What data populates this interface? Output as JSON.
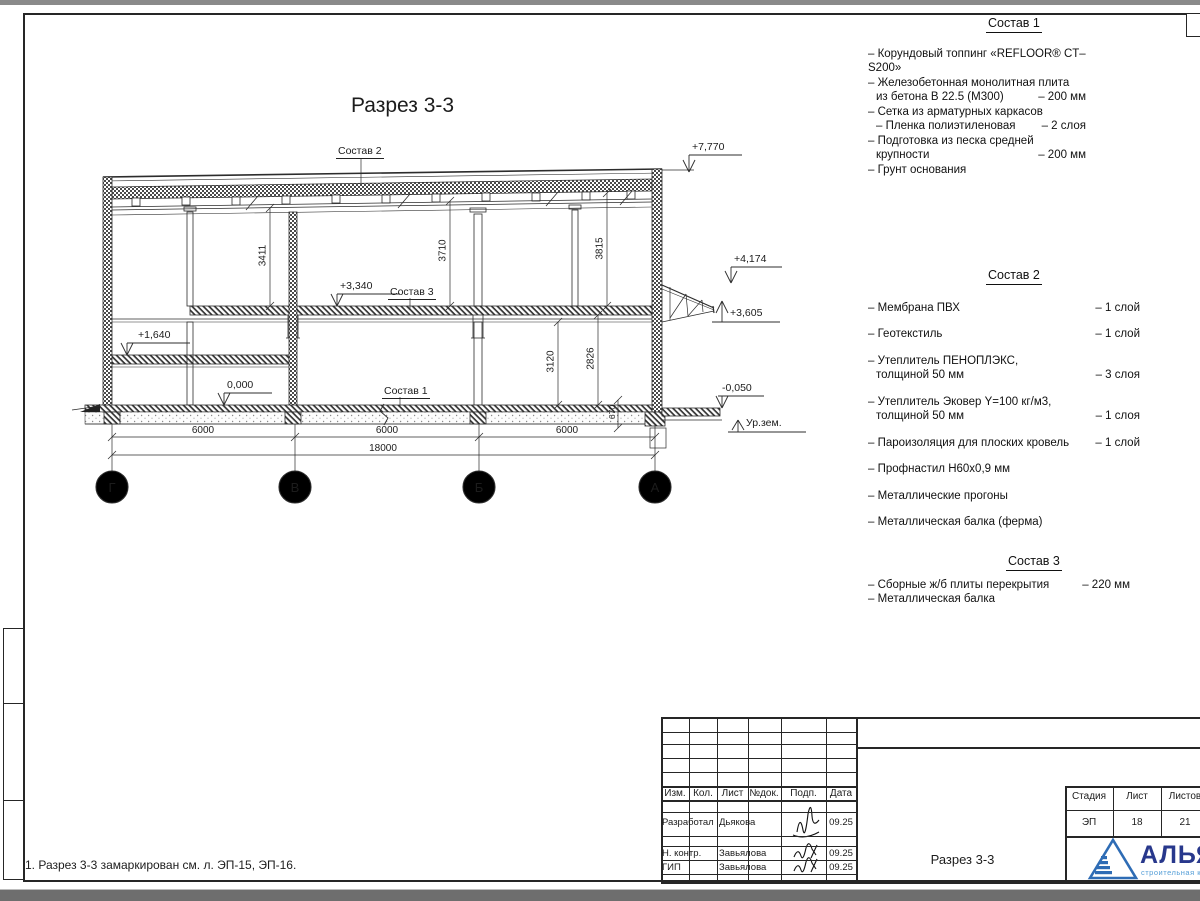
{
  "chrome": {
    "top_band": "#8a8a8a",
    "bottom_band": "#6e6e6e"
  },
  "drawing": {
    "title": "Разрез 3-3",
    "callouts": {
      "sostav1": "Состав 1",
      "sostav2": "Состав 2",
      "sostav3": "Состав 3"
    },
    "elevations": {
      "roof": "+7,770",
      "canopy_top": "+4,174",
      "canopy_bot": "+3,605",
      "slab": "+3,340",
      "mezz": "+1,640",
      "zero": "0,000",
      "outside": "-0,050",
      "ground": "Ур.зем."
    },
    "vdims": {
      "d1": "3411",
      "d2": "3710",
      "d3": "3815",
      "d4": "3120",
      "d5": "2826",
      "d6": "670"
    },
    "hdims": {
      "s1": "6000",
      "s2": "6000",
      "s3": "6000",
      "total": "18000"
    },
    "axes": {
      "a1": "Г",
      "a2": "В",
      "a3": "Б",
      "a4": "А"
    }
  },
  "specs": {
    "s1": {
      "title": "Состав 1",
      "items": [
        {
          "t": "– Корундовый топпинг «REFLOOR® CT–S200»",
          "v": ""
        },
        {
          "t": "– Железобетонная  монолитная плита",
          "v": ""
        },
        {
          "t": "из бетона В 22.5 (М300)",
          "v": "– 200 мм"
        },
        {
          "t": "– Сетка из арматурных каркасов",
          "v": ""
        },
        {
          "t": "– Пленка полиэтиленовая",
          "v": "– 2 слоя"
        },
        {
          "t": "– Подготовка из песка средней",
          "v": ""
        },
        {
          "t": "крупности",
          "v": "– 200 мм"
        },
        {
          "t": "– Грунт основания",
          "v": ""
        }
      ]
    },
    "s2": {
      "title": "Состав 2",
      "items": [
        {
          "t": "– Мембрана ПВХ",
          "v": "– 1 слой"
        },
        {
          "t": "– Геотекстиль",
          "v": "– 1 слой"
        },
        {
          "t": "– Утеплитель ПЕНОПЛЭКС,",
          "v": ""
        },
        {
          "t": "толщиной 50 мм",
          "v": "– 3 слоя"
        },
        {
          "t": "– Утеплитель Эковер Y=100 кг/м3,",
          "v": ""
        },
        {
          "t": "толщиной 50 мм",
          "v": "– 1 слоя"
        },
        {
          "t": "– Пароизоляция для плоских кровель",
          "v": "– 1 слой"
        },
        {
          "t": "– Профнастил Н60х0,9 мм",
          "v": ""
        },
        {
          "t": "– Металлические прогоны",
          "v": ""
        },
        {
          "t": "– Металлическая балка (ферма)",
          "v": ""
        }
      ]
    },
    "s3": {
      "title": "Состав 3",
      "items": [
        {
          "t": "– Сборные ж/б плиты перекрытия",
          "v": "– 220 мм"
        },
        {
          "t": "– Металлическая балка",
          "v": ""
        }
      ]
    }
  },
  "note": "1. Разрез 3-3 замаркирован см. л. ЭП-15, ЭП-16.",
  "titleblock": {
    "cols": {
      "izm": "Изм.",
      "kol": "Кол.",
      "list": "Лист",
      "ndok": "№док.",
      "podp": "Подп.",
      "data": "Дата"
    },
    "rows": [
      {
        "role": "Разработал",
        "name": "Дьякова",
        "date": "09.25"
      },
      {
        "role": "Н. контр.",
        "name": "Завьялова",
        "date": "09.25"
      },
      {
        "role": "ГИП",
        "name": "Завьялова",
        "date": "09.25"
      }
    ],
    "doc": "Разрез 3-3",
    "stage": {
      "h": "Стадия",
      "v": "ЭП"
    },
    "sheet": {
      "h": "Лист",
      "v": "18"
    },
    "sheets": {
      "h": "Листов",
      "v": "21"
    },
    "logo": {
      "name": "АЛЬЯНС",
      "tagline": "строительная компания"
    }
  }
}
